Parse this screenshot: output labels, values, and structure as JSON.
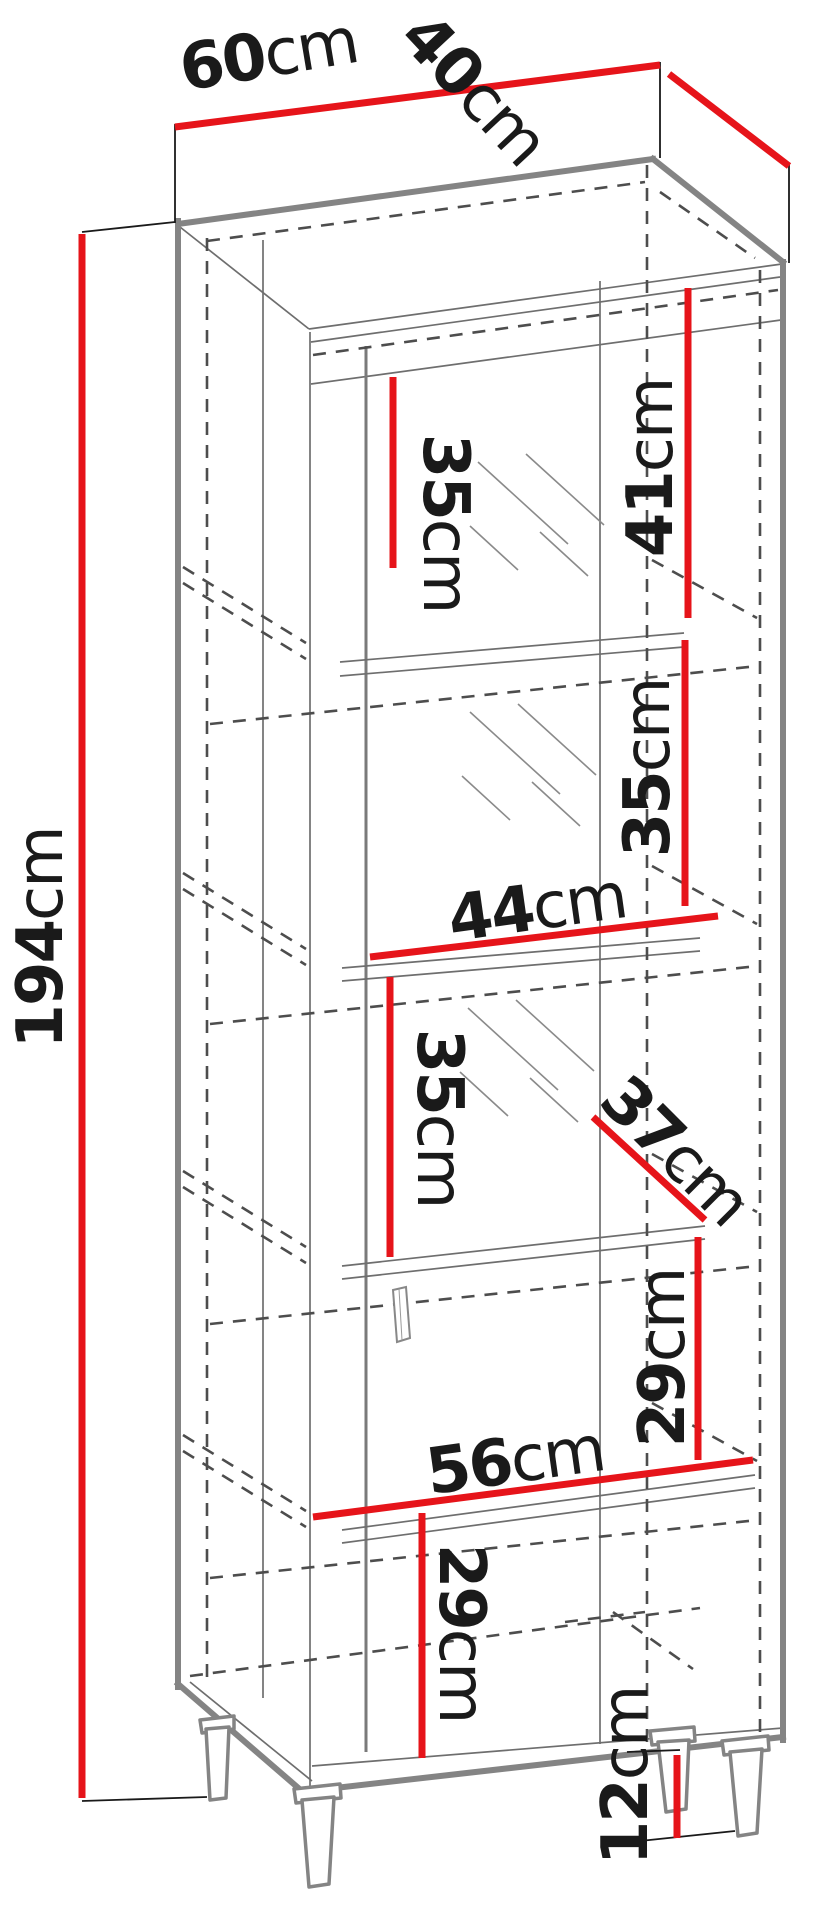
{
  "title": "cabinet-dimension-diagram",
  "colors": {
    "dimension_red": "#e6141a",
    "carcass_gray": "#848484",
    "hidden_line": "#4d4d4d",
    "text": "#1a1a1a"
  },
  "dims": {
    "width": {
      "value": "60",
      "unit": "cm"
    },
    "depth": {
      "value": "40",
      "unit": "cm"
    },
    "height": {
      "value": "194",
      "unit": "cm"
    },
    "shelf_top": {
      "value": "35",
      "unit": "cm"
    },
    "top_right_section": {
      "value": "41",
      "unit": "cm"
    },
    "shelf_middle": {
      "value": "35",
      "unit": "cm"
    },
    "inner_width_upper": {
      "value": "44",
      "unit": "cm"
    },
    "shelf_lower": {
      "value": "35",
      "unit": "cm"
    },
    "door_diagonal": {
      "value": "37",
      "unit": "cm"
    },
    "section_right": {
      "value": "29",
      "unit": "cm"
    },
    "inner_width_lower": {
      "value": "56",
      "unit": "cm"
    },
    "section_bottom": {
      "value": "29",
      "unit": "cm"
    },
    "leg_height": {
      "value": "12",
      "unit": "cm"
    }
  }
}
